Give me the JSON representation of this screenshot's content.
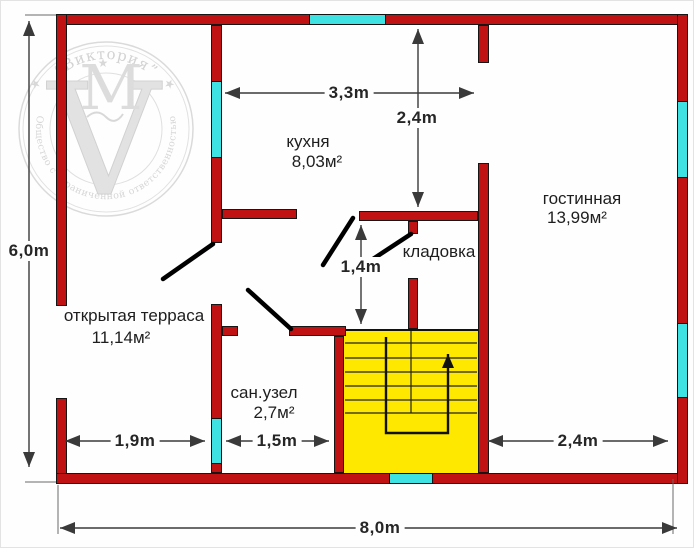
{
  "watermark": {
    "company_quoted": "“Виктория”",
    "monogram_v": "V",
    "monogram_m": "M",
    "ring_text": "Общество с ограниченной ответственностью",
    "star": "★"
  },
  "rooms": {
    "kitchen": {
      "name": "кухня",
      "area": "8,03м²"
    },
    "living": {
      "name": "гостинная",
      "area": "13,99м²"
    },
    "storage": {
      "name": "кладовка"
    },
    "terrace": {
      "name": "открытая терраса",
      "area": "11,14м²"
    },
    "bathroom": {
      "name": "сан.узел",
      "area": "2,7м²"
    }
  },
  "dimensions": {
    "height_total": "6,0m",
    "kitchen_width": "3,3m",
    "kitchen_depth": "2,4m",
    "hall_width": "1,4m",
    "terrace_width": "1,9m",
    "bathroom_width": "1,5m",
    "living_width": "2,4m",
    "width_total": "8,0m"
  },
  "colors": {
    "wall": "#c01212",
    "window": "#3fe2e2",
    "stairs": "#ffe800",
    "watermark": "#d2d2d2",
    "dimension_line": "#3a3a3a"
  }
}
